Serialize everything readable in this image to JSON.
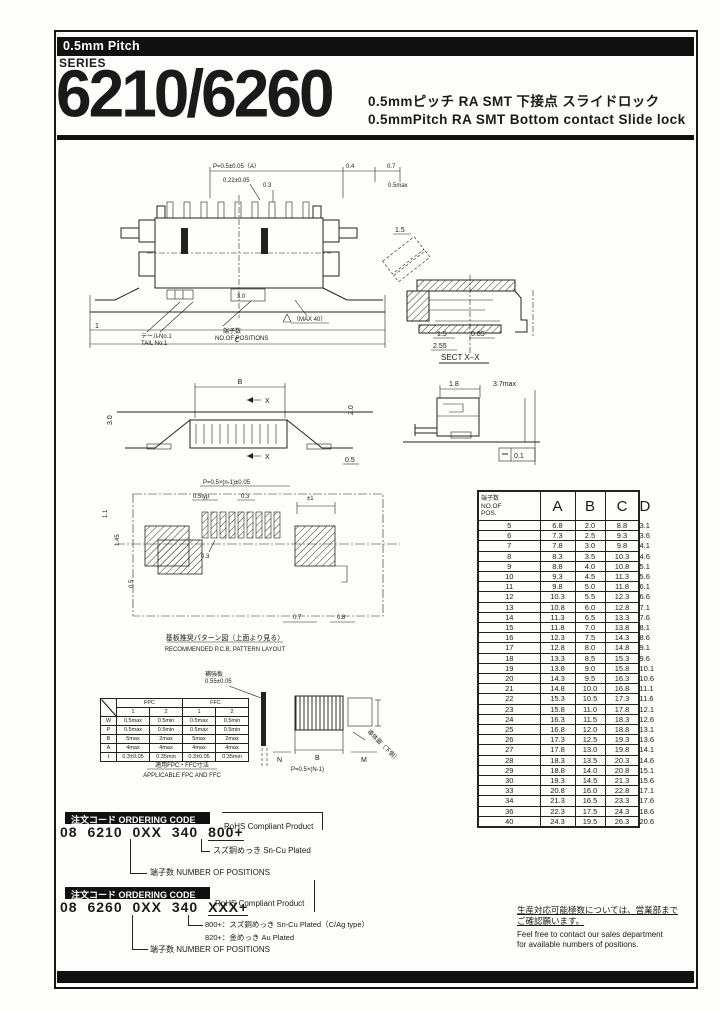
{
  "colors": {
    "ink": "#1a1a1a",
    "paper": "#ffffff",
    "bar": "#111111"
  },
  "header": {
    "pitch_badge": "0.5mm Pitch",
    "series_label": "SERIES",
    "series_number": "6210/6260",
    "subtitle_jp": "0.5mmピッチ RA SMT 下接点 スライドロック",
    "subtitle_en": "0.5mmPitch RA SMT Bottom contact Slide lock"
  },
  "drawings": {
    "top_view": {
      "dim_pitch": "P=0.5±0.05（A）",
      "dim_04": "0.4",
      "dim_07": "0.7",
      "dim_022": "0.22±0.05",
      "dim_03": "0.3",
      "dim_05max": "0.5max",
      "dim_30": "3.0",
      "dim_1": "1",
      "dim_c": "C",
      "label_tail_jp": "テールNo.1",
      "label_tail_en": "TAIL No.1",
      "label_pos_jp": "端子数",
      "label_pos_en": "NO.OF POSITIONS",
      "label_max": "（MAX 40）"
    },
    "section_view": {
      "dim_15a": "1.5",
      "dim_15b": "1.5",
      "dim_255": "2.55",
      "dim_085": "0.85",
      "caption": "SECT X–X"
    },
    "front_view": {
      "dim_b": "B",
      "x_top": "X",
      "x_bottom": "X",
      "dim_20": "2.0",
      "dim_30": "3.0",
      "dim_05": "0.5"
    },
    "side_view": {
      "dim_18": "1.8",
      "dim_37": "3.7max",
      "dim_01": "0.1"
    },
    "pcb_view": {
      "dim_pitch": "P=0.5×(n-1)±0.05",
      "dim_05typ": "0.5typ",
      "dim_03top": "0.3",
      "dim_pm1": "±1",
      "dim_11": "1.1",
      "dim_145": "1.45",
      "dim_05": "0.5",
      "dim_03": "0.3",
      "dim_07": "0.7",
      "dim_08": "0.8",
      "caption_jp": "基板推奨パターン図（上面より見る）",
      "caption_en": "RECOMMENDED P.C.B. PATTERN LAYOUT"
    },
    "fpc_view": {
      "stiffener_jp": "補強板",
      "stiffener_dim": "0.55±0.05",
      "conductor": "導体面（下側）",
      "dim_n": "N",
      "dim_b": "B",
      "dim_m": "M",
      "dim_pitch": "P=0.5×(N-1)",
      "caption_jp": "適用FPC・FFC寸法",
      "caption_en": "APPLICABLE FPC AND FFC"
    }
  },
  "fpc_table": {
    "group_headers": [
      "FPC",
      "FFC"
    ],
    "sub_headers": [
      "1",
      "2",
      "1",
      "2"
    ],
    "rows": [
      {
        "label": "W",
        "values": [
          "0.5max",
          "0.5min",
          "0.5max",
          "0.5min"
        ]
      },
      {
        "label": "P",
        "values": [
          "0.5max",
          "0.5min",
          "0.5max",
          "0.5min"
        ]
      },
      {
        "label": "B",
        "values": [
          "5max",
          "2max",
          "5max",
          "2max"
        ]
      },
      {
        "label": "A",
        "values": [
          "4max",
          "4max",
          "4max",
          "4max"
        ]
      },
      {
        "label": "t",
        "values": [
          "0.3±0.05",
          "0.35min",
          "0.3±0.05",
          "0.35min"
        ]
      }
    ]
  },
  "dim_table": {
    "header": {
      "pos_jp": "端子数",
      "pos_en1": "NO.OF",
      "pos_en2": "POS.",
      "cols": [
        "A",
        "B",
        "C",
        "D"
      ]
    },
    "rows": [
      [
        "5",
        "6.8",
        "2.0",
        "8.8",
        "3.1"
      ],
      [
        "6",
        "7.3",
        "2.5",
        "9.3",
        "3.6"
      ],
      [
        "7",
        "7.8",
        "3.0",
        "9.8",
        "4.1"
      ],
      [
        "8",
        "8.3",
        "3.5",
        "10.3",
        "4.6"
      ],
      [
        "9",
        "8.8",
        "4.0",
        "10.8",
        "5.1"
      ],
      [
        "10",
        "9.3",
        "4.5",
        "11.3",
        "5.6"
      ],
      [
        "11",
        "9.8",
        "5.0",
        "11.8",
        "6.1"
      ],
      [
        "12",
        "10.3",
        "5.5",
        "12.3",
        "6.6"
      ],
      [
        "13",
        "10.8",
        "6.0",
        "12.8",
        "7.1"
      ],
      [
        "14",
        "11.3",
        "6.5",
        "13.3",
        "7.6"
      ],
      [
        "15",
        "11.8",
        "7.0",
        "13.8",
        "8.1"
      ],
      [
        "16",
        "12.3",
        "7.5",
        "14.3",
        "8.6"
      ],
      [
        "17",
        "12.8",
        "8.0",
        "14.8",
        "9.1"
      ],
      [
        "18",
        "13.3",
        "8.5",
        "15.3",
        "9.6"
      ],
      [
        "19",
        "13.8",
        "9.0",
        "15.8",
        "10.1"
      ],
      [
        "20",
        "14.3",
        "9.5",
        "16.3",
        "10.6"
      ],
      [
        "21",
        "14.8",
        "10.0",
        "16.8",
        "11.1"
      ],
      [
        "22",
        "15.3",
        "10.5",
        "17.3",
        "11.6"
      ],
      [
        "23",
        "15.8",
        "11.0",
        "17.8",
        "12.1"
      ],
      [
        "24",
        "16.3",
        "11.5",
        "18.3",
        "12.6"
      ],
      [
        "25",
        "16.8",
        "12.0",
        "18.8",
        "13.1"
      ],
      [
        "26",
        "17.3",
        "12.5",
        "19.3",
        "13.6"
      ],
      [
        "27",
        "17.8",
        "13.0",
        "19.8",
        "14.1"
      ],
      [
        "28",
        "18.3",
        "13.5",
        "20.3",
        "14.6"
      ],
      [
        "29",
        "18.8",
        "14.0",
        "20.8",
        "15.1"
      ],
      [
        "30",
        "19.3",
        "14.5",
        "21.3",
        "15.6"
      ],
      [
        "33",
        "20.8",
        "16.0",
        "22.8",
        "17.1"
      ],
      [
        "34",
        "21.3",
        "16.5",
        "23.3",
        "17.6"
      ],
      [
        "36",
        "22.3",
        "17.5",
        "24.3",
        "18.6"
      ],
      [
        "40",
        "24.3",
        "19.5",
        "26.3",
        "20.6"
      ]
    ]
  },
  "ordering_code_1": {
    "title": "注文コード ORDERING CODE",
    "code_main": "08 6210 0XX 340",
    "code_suffix": "800+",
    "rohs": "RoHS Compliant Product",
    "callout_plating": "スズ銅めっき  Sn-Cu Plated",
    "callout_positions": "端子数 NUMBER OF POSITIONS"
  },
  "ordering_code_2": {
    "title": "注文コード ORDERING CODE",
    "code_main": "08 6260 0XX 340",
    "code_suffix": "XXX+",
    "rohs": "RoHS Compliant Product",
    "callout_800": "800+：スズ銅めっき  Sn-Cu Plated（C/Ag type）",
    "callout_820": "820+：金めっき  Au Plated",
    "callout_positions": "端子数 NUMBER OF POSITIONS"
  },
  "footnote": {
    "jp1": "生産対応可能極数については、営業部まで",
    "jp2": "ご確認願います。",
    "en1": "Feel free to contact our sales department",
    "en2": "for available numbers of positions."
  }
}
